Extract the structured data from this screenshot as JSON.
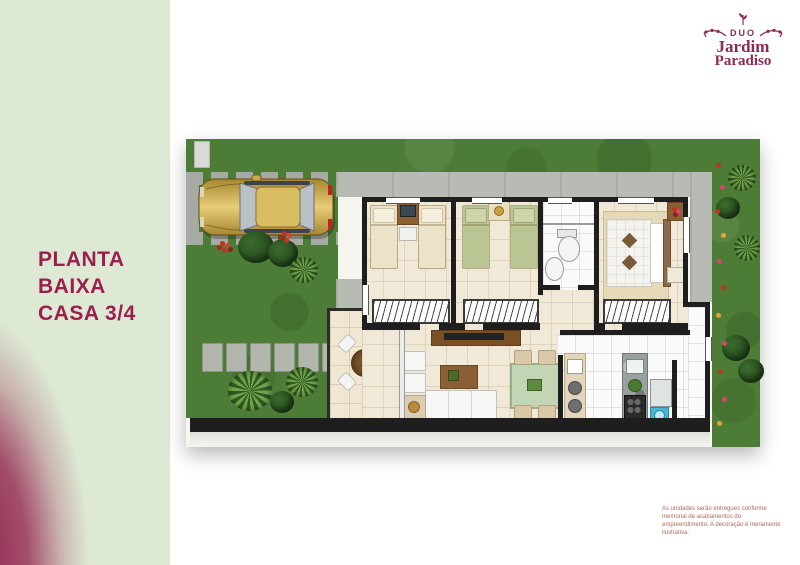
{
  "sidebar": {
    "title_lines": [
      "PLANTA",
      "BAIXA",
      "CASA 3/4"
    ]
  },
  "logo": {
    "top": "DUO",
    "name": "Jardim",
    "subname": "Paradiso"
  },
  "disclaimer": {
    "text": "As unidades serão entregues conforme memorial de acabamentos do empreendimento. A decoração é meramente ilustrativa."
  },
  "colors": {
    "brand_maroon": "#8e2a55",
    "title_text": "#9b1f4e",
    "panel_green": "#dde9d3",
    "panel_gradient_maroon": "#8e1d4c",
    "disclaimer_text": "#b2675e",
    "grass_green": "#4c7c35",
    "concrete_gray": "#b8bab4",
    "wall_black": "#1e1e1e",
    "floor_cream": "#f1e9d7",
    "floor_white": "#fafafa",
    "car_gold": "#c9a851",
    "flower_red": "#c23323",
    "washer_blue": "#49b6d2"
  },
  "floorplan": {
    "features": [
      "garden",
      "driveway",
      "parked-car",
      "stepping-stones",
      "bedroom-1",
      "bedroom-2",
      "bathroom",
      "master-bedroom",
      "hallway",
      "living-room",
      "dining-area",
      "kitchen",
      "service-area",
      "patio",
      "sofa",
      "armchairs",
      "coffee-table",
      "tv-panel",
      "dining-table",
      "round-patio-table",
      "beds",
      "wardrobes",
      "toilet",
      "sink",
      "stove",
      "fridge",
      "washing-machine",
      "plants",
      "flowers"
    ]
  }
}
